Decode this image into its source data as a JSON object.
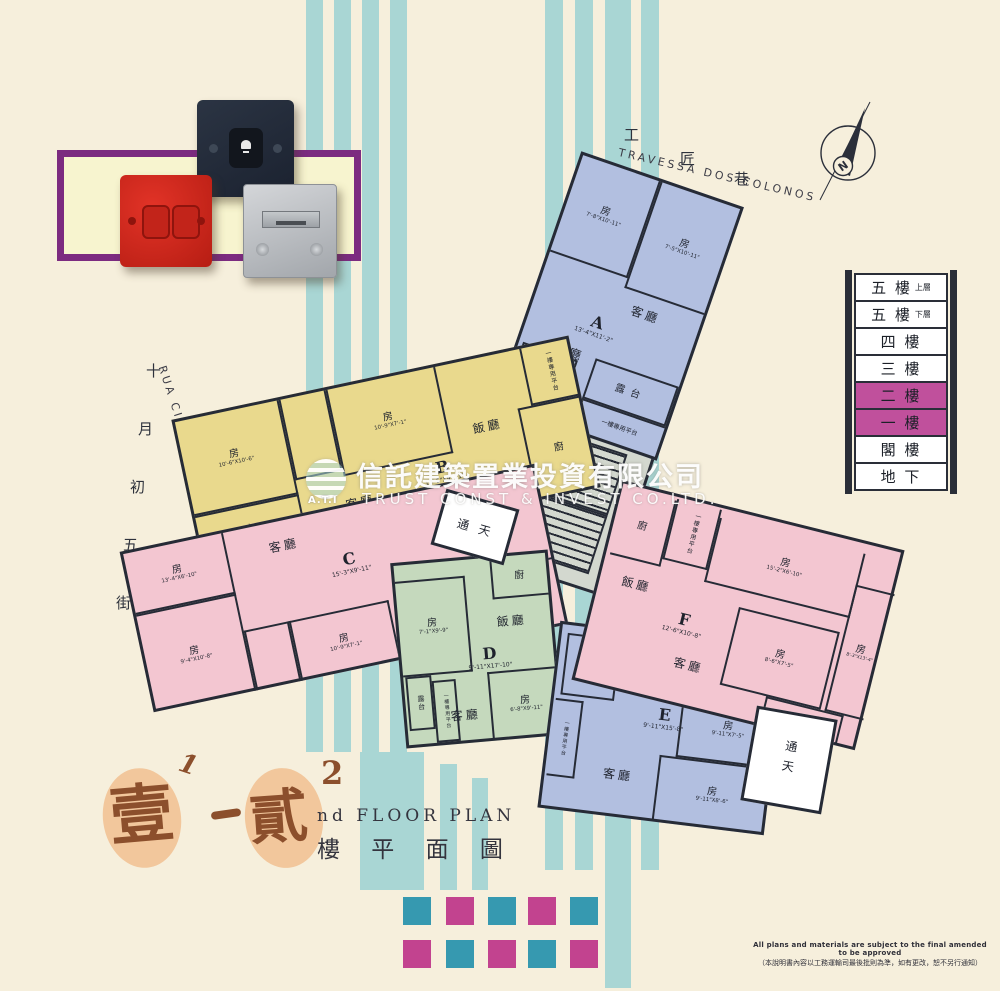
{
  "colors": {
    "background": "#f6efdc",
    "stripe_teal": "#a9d6d4",
    "wall": "#262b36",
    "unit_blue": "#b2bfe0",
    "unit_yellow": "#e9d98d",
    "unit_pink": "#f3c6d1",
    "unit_green": "#c5d9bd",
    "core_gray": "#d3d8cf",
    "legend_highlight": "#c0509c",
    "square_teal": "#3699b0",
    "square_magenta": "#c2438f",
    "title_brown": "#8c4f2c",
    "panel_purple": "#7c2b80"
  },
  "streets": {
    "top": {
      "cn_chars": [
        "工",
        "匠",
        "巷"
      ],
      "pt": "TRAVESSA DOS COLONOS"
    },
    "left": {
      "cn_chars": [
        "十",
        "月",
        "初",
        "五",
        "街"
      ],
      "pt": "RUA CINCO DE OUTUBRO"
    }
  },
  "compass": {
    "label": "N"
  },
  "watermark": {
    "logo": "A.T.I",
    "cn": "信託建築置業投資有限公司",
    "en": "TRUST CONST & INVEST CO.LTD."
  },
  "legend": {
    "floors": [
      {
        "label": "五 樓",
        "sub": "上層"
      },
      {
        "label": "五 樓",
        "sub": "下層"
      },
      {
        "label": "四 樓"
      },
      {
        "label": "三 樓"
      },
      {
        "label": "二 樓",
        "highlight": true
      },
      {
        "label": "一 樓",
        "highlight": true
      },
      {
        "label": "閣 樓"
      },
      {
        "label": "地 下"
      }
    ]
  },
  "plan": {
    "lightwell": "通天",
    "units": {
      "A": {
        "label": "A",
        "dim": "13'-4\"X11'-2\"",
        "color": "#b2bfe0",
        "rooms": [
          {
            "n": "房",
            "d": "7'-8\"X10'-11\""
          },
          {
            "n": "房",
            "d": "7'-5\"X10'-11\""
          },
          {
            "n": "客廳"
          },
          {
            "n": "飯廳"
          },
          {
            "n": "廚"
          },
          {
            "n": "露台"
          },
          {
            "n": "一樓專用平台"
          }
        ]
      },
      "B": {
        "label": "B",
        "dim": "13'-5\"X9'-11\"",
        "color": "#e9d98d",
        "rooms": [
          {
            "n": "房",
            "d": "10'-6\"X10'-6\""
          },
          {
            "n": "房",
            "d": "10'-9\"X7'-1\""
          },
          {
            "n": "房",
            "d": "13'-5\"X6'-10\""
          },
          {
            "n": "客廳"
          },
          {
            "n": "飯廳"
          },
          {
            "n": "廚"
          },
          {
            "n": "一樓專用平台"
          }
        ]
      },
      "C": {
        "label": "C",
        "dim": "15'-3\"X9'-11\"",
        "color": "#f3c6d1",
        "rooms": [
          {
            "n": "房",
            "d": "13'-4\"X6'-10\""
          },
          {
            "n": "房",
            "d": "9'-4\"X10'-8\""
          },
          {
            "n": "房",
            "d": "10'-9\"X7'-1\""
          },
          {
            "n": "客廳"
          },
          {
            "n": "飯廳"
          },
          {
            "n": "廚"
          },
          {
            "n": "一樓專用平台"
          }
        ]
      },
      "D": {
        "label": "D",
        "dim": "9'-11\"X17'-10\"",
        "color": "#c5d9bd",
        "rooms": [
          {
            "n": "房",
            "d": "7'-1\"X9'-9\""
          },
          {
            "n": "房",
            "d": "6'-8\"X9'-11\""
          },
          {
            "n": "客廳"
          },
          {
            "n": "飯廳"
          },
          {
            "n": "廚"
          },
          {
            "n": "露台"
          },
          {
            "n": "一樓專用平台"
          }
        ]
      },
      "E": {
        "label": "E",
        "dim": "9'-11\"X15'-8\"",
        "color": "#b2bfe0",
        "rooms": [
          {
            "n": "房",
            "d": "9'-11\"X7'-5\""
          },
          {
            "n": "房",
            "d": "9'-11\"X8'-6\""
          },
          {
            "n": "客廳"
          },
          {
            "n": "飯廳"
          },
          {
            "n": "廚"
          },
          {
            "n": "一樓專用平台"
          }
        ]
      },
      "F": {
        "label": "F",
        "dim": "12'-6\"X10'-8\"",
        "color": "#f3c6d1",
        "rooms": [
          {
            "n": "房",
            "d": "15'-2\"X6'-10\""
          },
          {
            "n": "房",
            "d": "8'-6\"X7'-5\""
          },
          {
            "n": "房",
            "d": "8'-3\"X13'-4\""
          },
          {
            "n": "客廳"
          },
          {
            "n": "飯廳"
          },
          {
            "n": "廚"
          },
          {
            "n": "露台"
          },
          {
            "n": "一樓專用平台"
          }
        ]
      }
    }
  },
  "title": {
    "char1": "壹",
    "sup1": "1",
    "char2": "貳",
    "sup2": "2",
    "en": "nd FLOOR PLAN",
    "cn": "樓 平 面 圖"
  },
  "disclaimer": {
    "en": "All plans and materials are subject to the final amended to be approved",
    "cn": "（本說明書內容以工務運輸司最後批則為準，如有更改，恕不另行通知）"
  },
  "footer_pattern": {
    "rows": [
      [
        "teal",
        "magenta",
        "teal",
        "magenta",
        "teal"
      ],
      [
        "magenta",
        "teal",
        "magenta",
        "teal",
        "magenta"
      ]
    ]
  }
}
